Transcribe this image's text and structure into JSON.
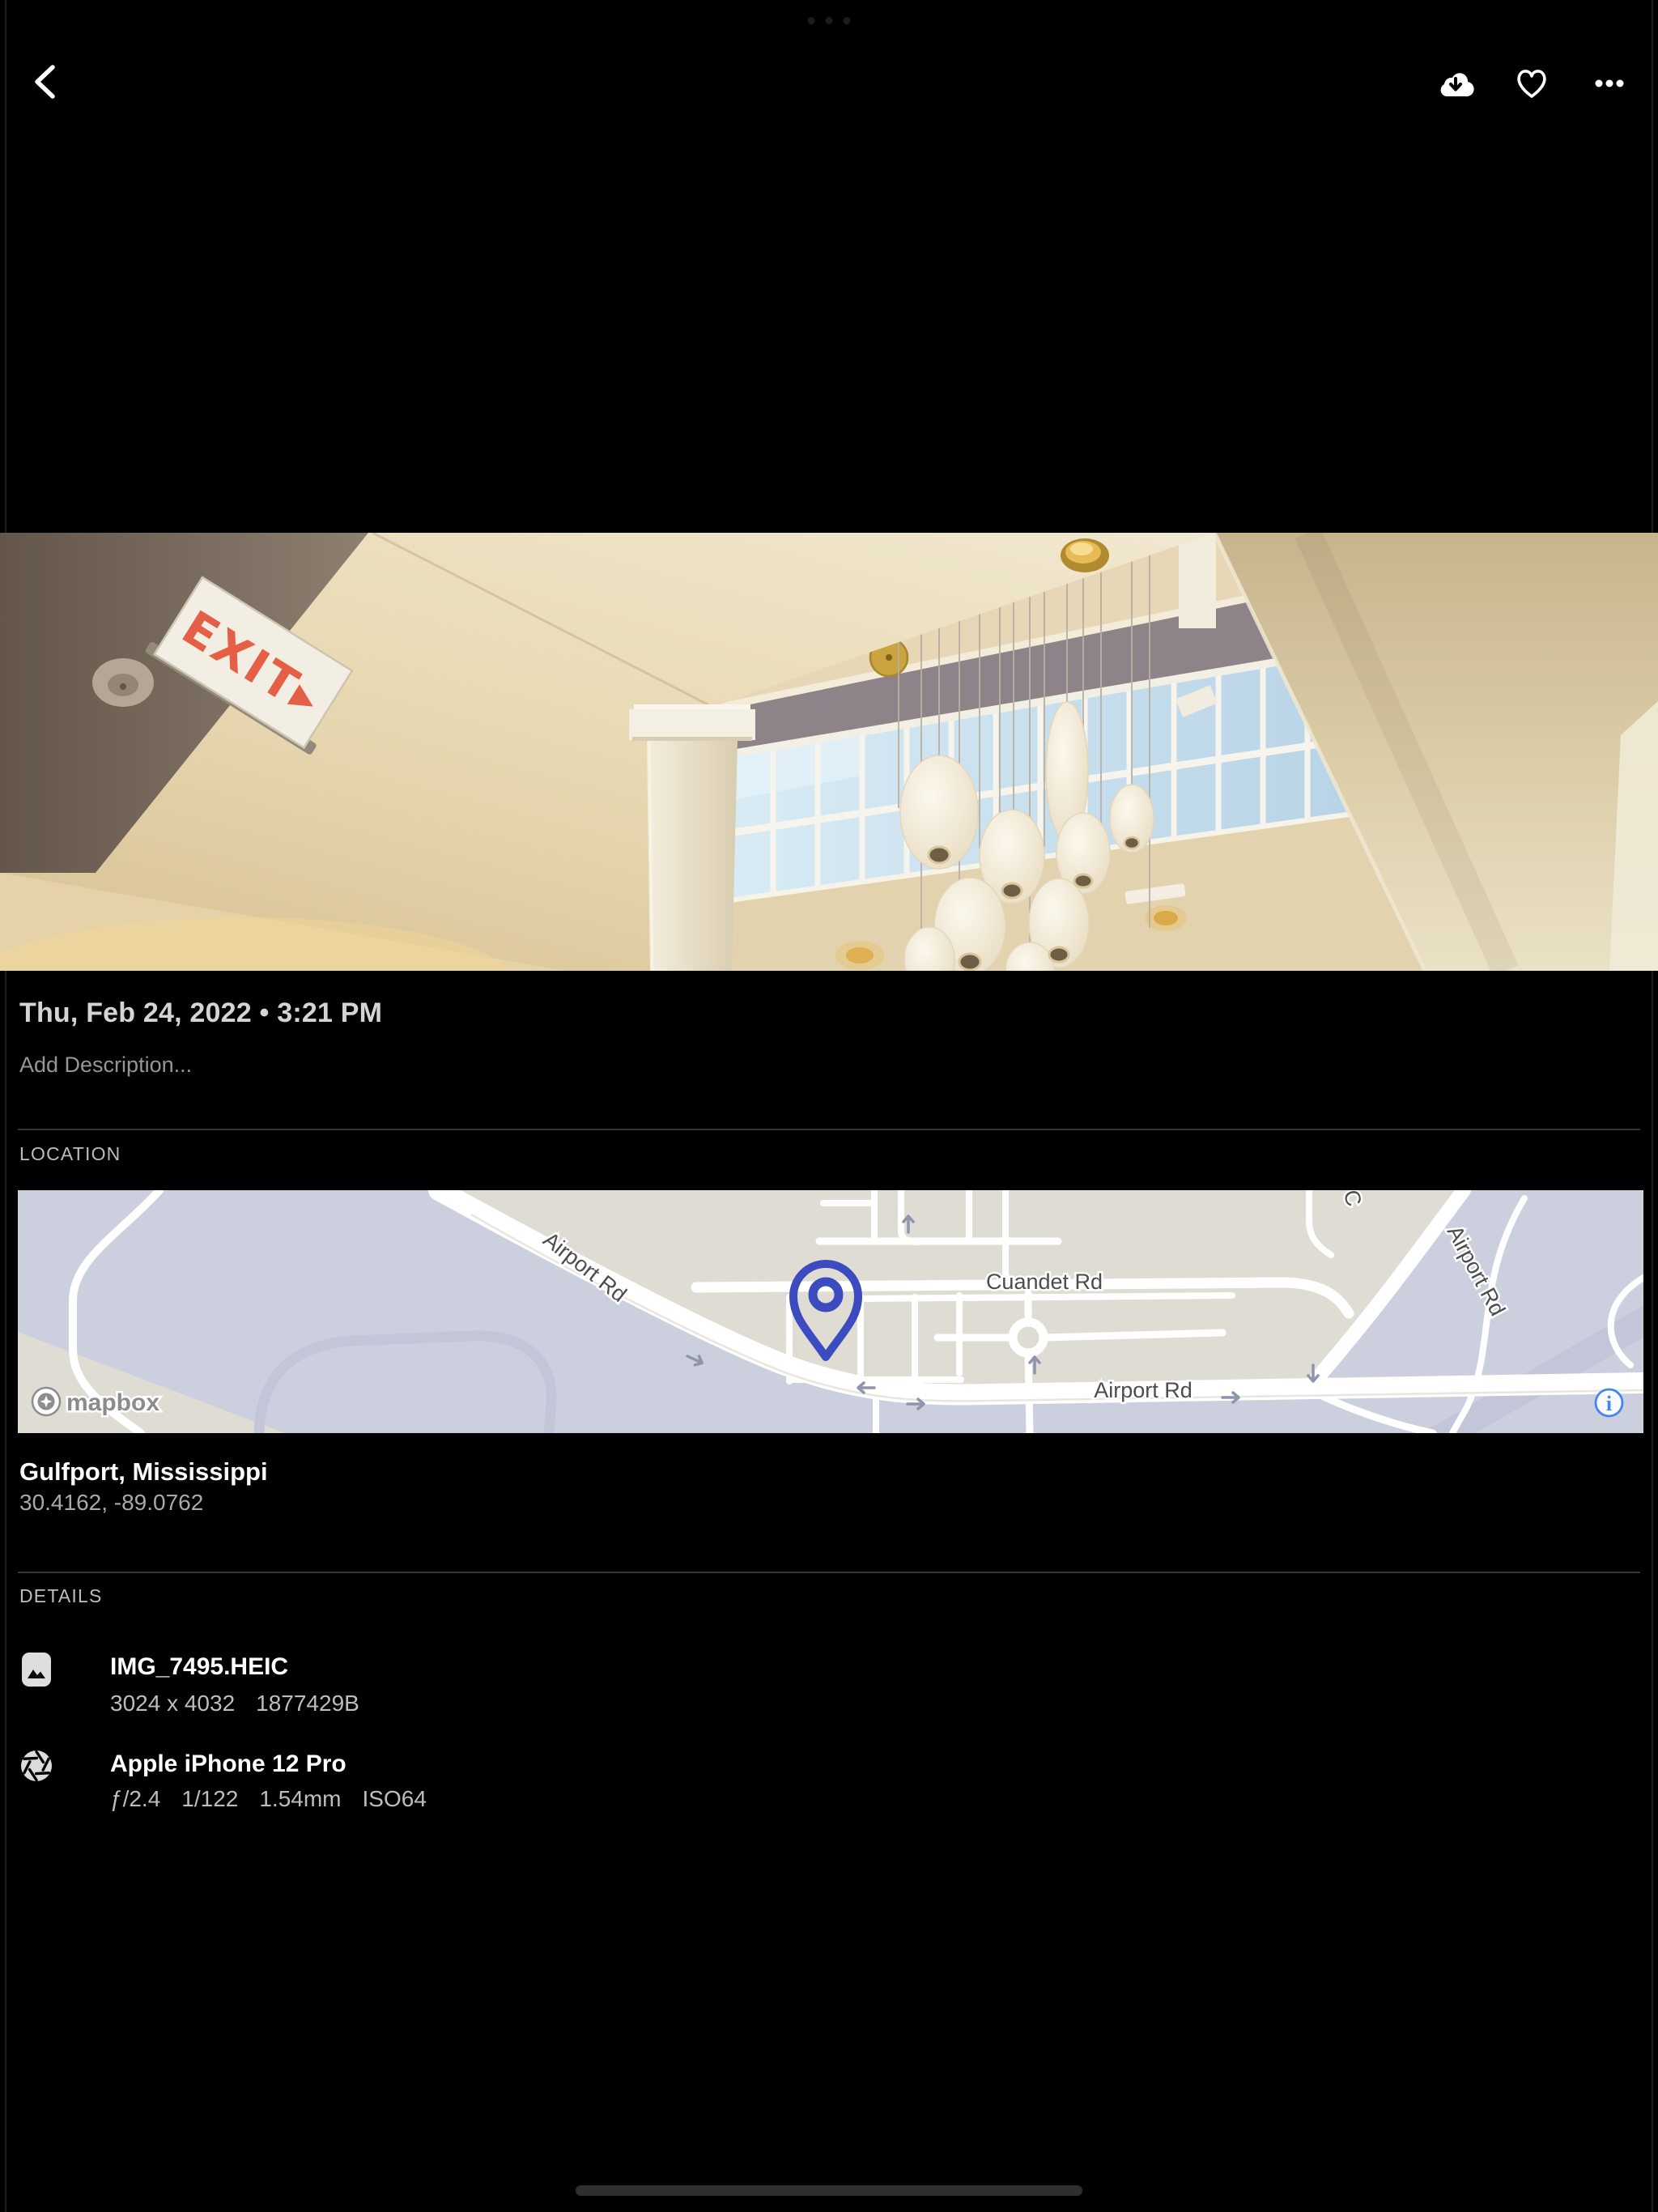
{
  "photo": {
    "exit_sign": "EXIT▸"
  },
  "meta": {
    "datetime": "Thu, Feb 24, 2022 • 3:21 PM",
    "description_placeholder": "Add Description..."
  },
  "location": {
    "section": "LOCATION",
    "place": "Gulfport, Mississippi",
    "coordinates": "30.4162, -89.0762",
    "map": {
      "attribution": "mapbox",
      "info_glyph": "i",
      "labels": {
        "airport_diag": "Airport Rd",
        "cuandet": "Cuandet Rd",
        "airport_bottom": "Airport Rd",
        "airport_topright": "Airport Rd",
        "fragment": "C"
      }
    }
  },
  "details": {
    "section": "DETAILS",
    "file": {
      "name": "IMG_7495.HEIC",
      "resolution": "3024 x 4032",
      "size": "1877429B"
    },
    "camera": {
      "name": "Apple iPhone 12 Pro",
      "aperture": "ƒ/2.4",
      "shutter": "1/122",
      "focal_length": "1.54mm",
      "iso": "ISO64"
    }
  }
}
